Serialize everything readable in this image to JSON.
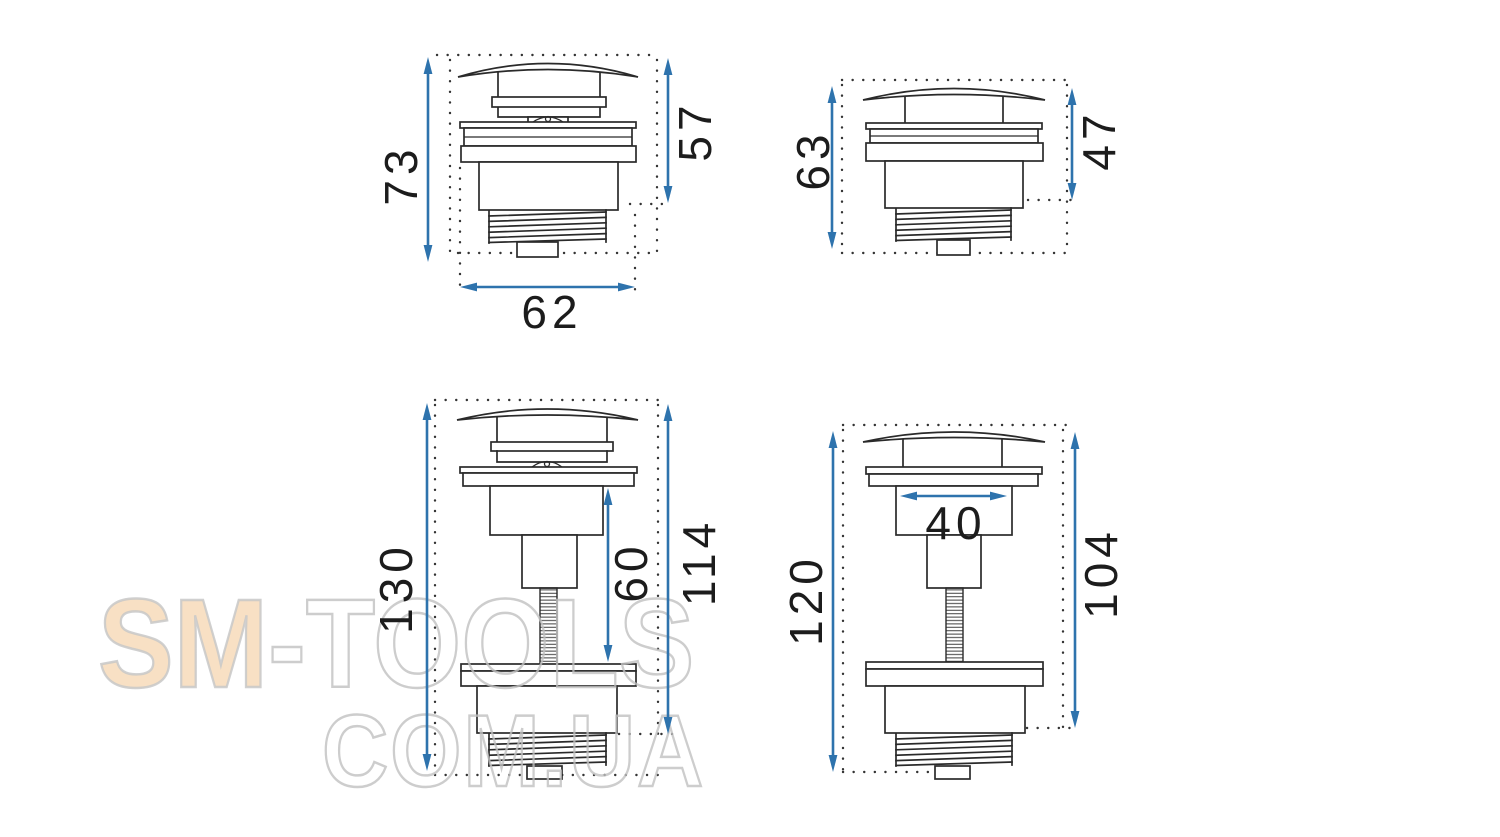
{
  "watermark": {
    "brand_left": "SM",
    "separator": "-",
    "brand_right": "TOOLS",
    "domain_line": "COM.UA"
  },
  "views": {
    "top_left": {
      "dims": {
        "height_total": "73",
        "height_upper": "57",
        "width": "62"
      }
    },
    "top_right": {
      "dims": {
        "height_total": "63",
        "height_upper": "47"
      }
    },
    "bottom_left": {
      "dims": {
        "height_total": "130",
        "stem_length": "60",
        "height_body": "114"
      }
    },
    "bottom_right": {
      "dims": {
        "height_total": "120",
        "inner_width": "40",
        "height_body": "104"
      }
    }
  },
  "colors": {
    "dimension_blue": "#2e73ad",
    "drawing_line": "#2a2a2a",
    "watermark_peach": "#f8e0c4",
    "watermark_outline": "#c1c1c1",
    "background": "#ffffff"
  }
}
